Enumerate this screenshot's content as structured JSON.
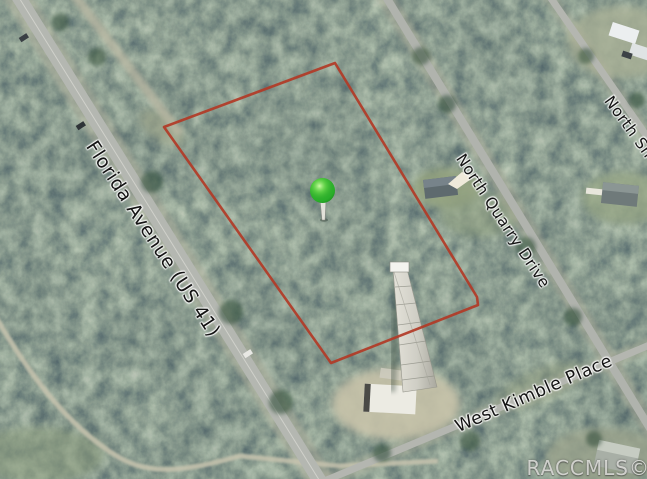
{
  "map": {
    "type": "aerial-satellite-parcel-view",
    "street_labels": {
      "florida_avenue": "Florida Avenue (US 41)",
      "north_quarry_drive": "North Quarry Drive",
      "north_sh": "North Sh",
      "west_kimble_place": "West Kimble Place"
    },
    "watermark": "RACCMLS©",
    "boundary": {
      "description": "red parcel outline",
      "color": "#b23a26"
    },
    "marker": {
      "style": "green-pushpin",
      "color": "#2eb82e"
    }
  }
}
